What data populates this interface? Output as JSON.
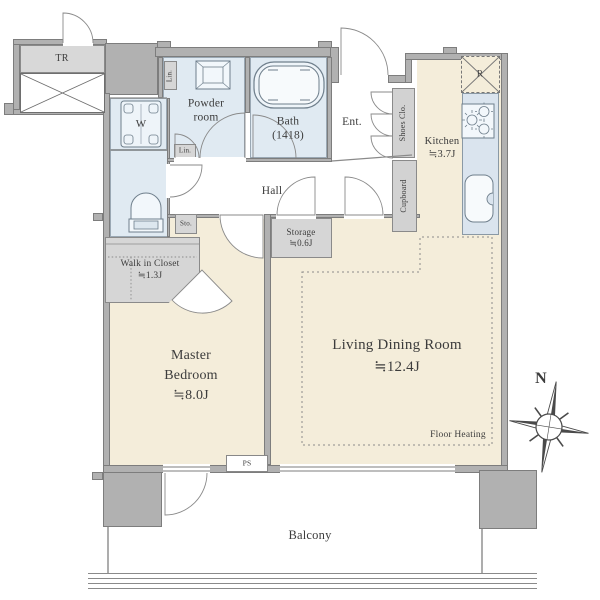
{
  "plan_title": "apartment-floor-plan",
  "rooms": {
    "trunk_room": {
      "name": "TR"
    },
    "washer": {
      "name": "W"
    },
    "linen_top": {
      "name": "Lin."
    },
    "linen_bottom": {
      "name": "Lin."
    },
    "small_storage": {
      "name": "Sto."
    },
    "powder_room": {
      "name_line1": "Powder",
      "name_line2": "room"
    },
    "bath": {
      "name": "Bath",
      "size": "(1418)"
    },
    "entrance": {
      "name": "Ent."
    },
    "shoes_closet": {
      "name": "Shoes Clo."
    },
    "cupboard": {
      "name": "Cupboard"
    },
    "kitchen": {
      "name": "Kitchen",
      "size": "≒3.7J"
    },
    "refrigerator": {
      "name": "R"
    },
    "hall": {
      "name": "Hall"
    },
    "storage": {
      "name": "Storage",
      "size": "≒0.6J"
    },
    "walk_in_closet": {
      "name": "Walk in Closet",
      "size": "≒1.3J"
    },
    "master_bedroom": {
      "name_line1": "Master",
      "name_line2": "Bedroom",
      "size": "≒8.0J"
    },
    "living_dining": {
      "name": "Living Dining Room",
      "size": "≒12.4J"
    },
    "balcony": {
      "name": "Balcony"
    },
    "pipe_space": {
      "name": "PS"
    }
  },
  "annotations": {
    "floor_heating": "Floor Heating",
    "compass_north": "N"
  },
  "colors": {
    "wall_gray": "#b1b1b1",
    "wall_edge": "#7d7d7d",
    "room_beige": "#f4edda",
    "wet_area_blue": "#e0eaf2",
    "counter_blue": "#dae4ee",
    "closet_gray": "#d6d6d6",
    "line_gray": "#787878",
    "text_gray": "#3c3c3c",
    "background": "#ffffff"
  }
}
